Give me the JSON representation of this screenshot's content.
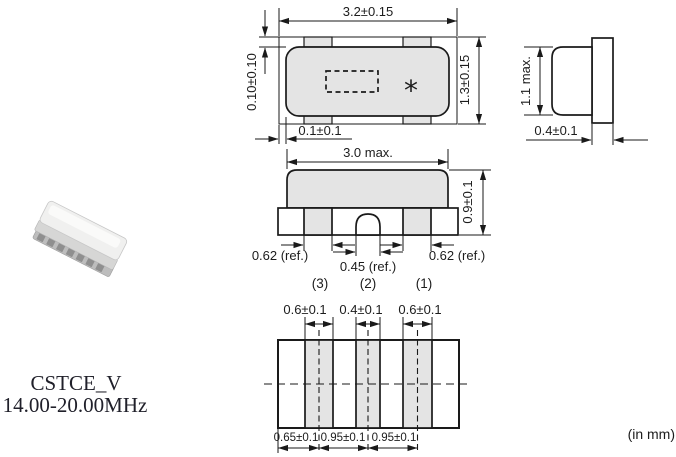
{
  "title_block": {
    "series": "CSTCE_V",
    "frequency_range": "14.00-20.00MHz",
    "units_note": "(in mm)"
  },
  "top_view": {
    "overall_width": "3.2±0.15",
    "overall_height": "1.3±0.15",
    "electrode_top_offset": "0.10±0.10",
    "electrode_side_offset": "0.1±0.1",
    "marking": "*"
  },
  "side_view": {
    "body_height": "1.1 max.",
    "terminal_thickness": "0.4±0.1"
  },
  "front_view": {
    "body_width": "3.0 max.",
    "overall_height": "0.9±0.1",
    "terminal3_width": "0.62 (ref.)",
    "terminal2_width": "0.45 (ref.)",
    "terminal1_width": "0.62 (ref.)",
    "terminal_labels": [
      "(3)",
      "(2)",
      "(1)"
    ]
  },
  "land_pattern": {
    "pad_widths": [
      "0.6±0.1",
      "0.4±0.1",
      "0.6±0.1"
    ],
    "pad_spacings": [
      "0.65±0.1",
      "0.95±0.1",
      "0.95±0.1"
    ]
  },
  "colors": {
    "line": "#1a1a1a",
    "body_fill": "#e4e4e4",
    "background": "#ffffff"
  }
}
